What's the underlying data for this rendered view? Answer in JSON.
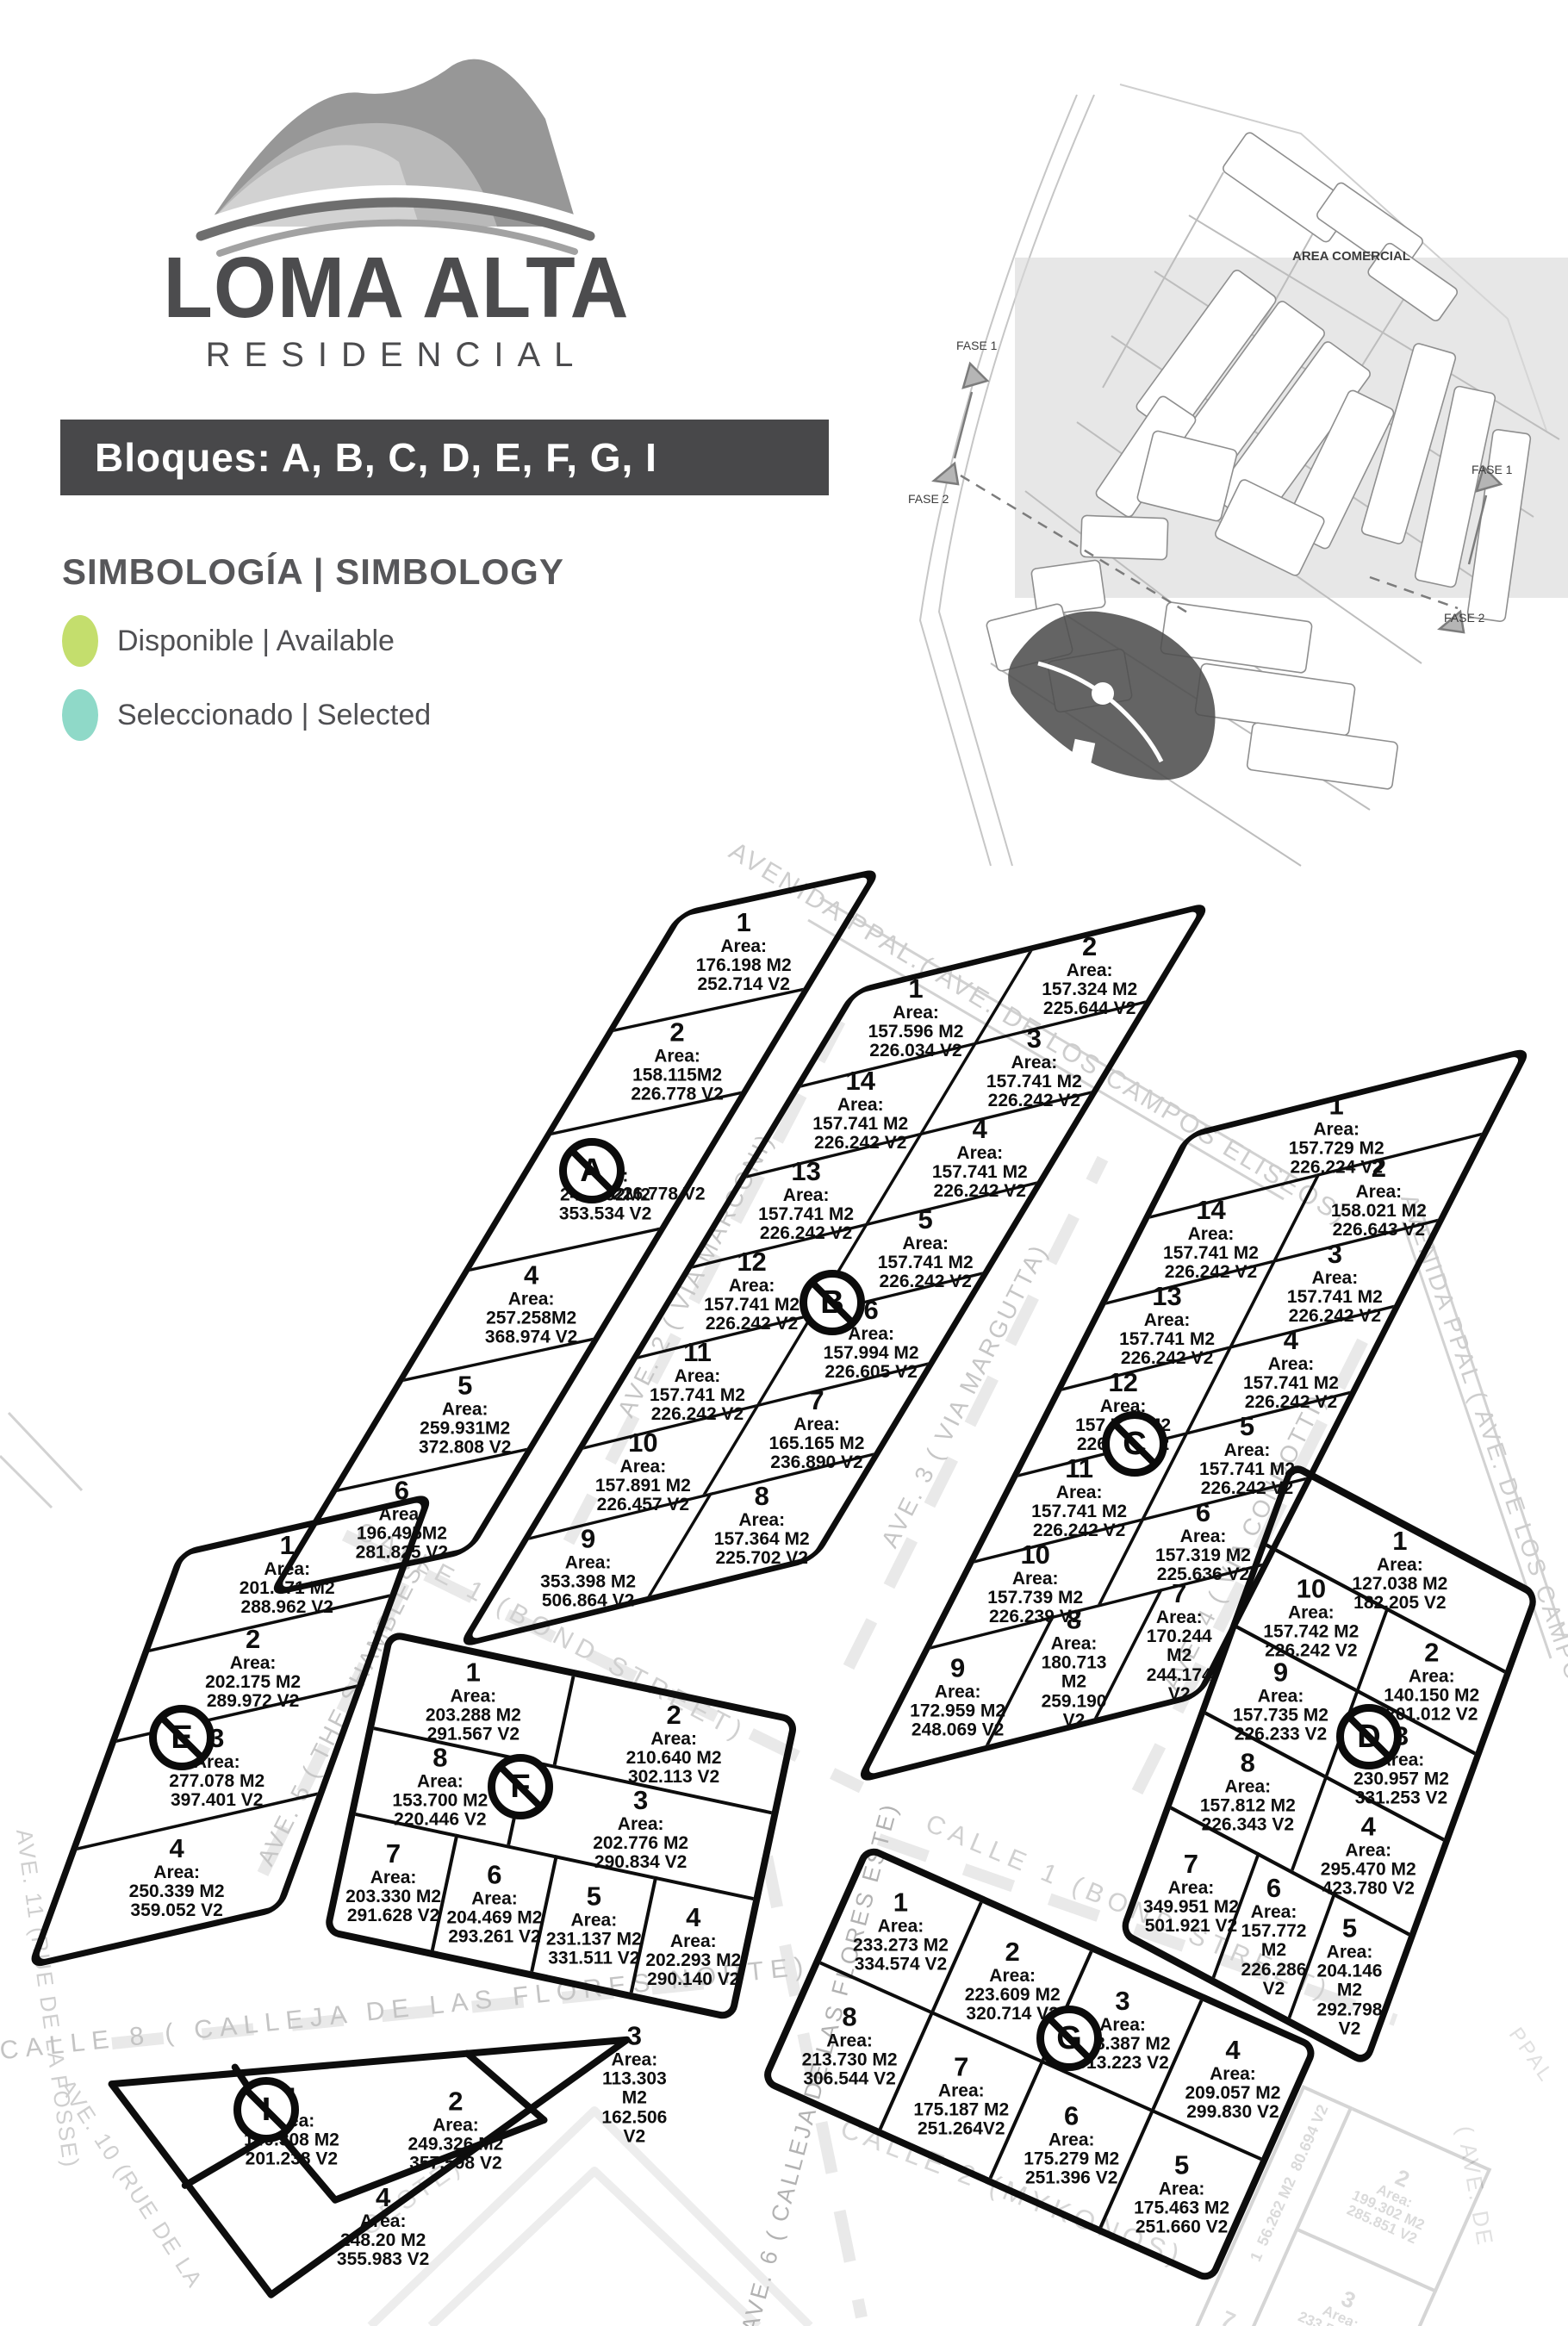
{
  "header": {
    "logo_title": "LOMA ALTA",
    "logo_subtitle": "RESIDENCIAL",
    "banner": "Bloques: A, B, C, D, E, F, G, I"
  },
  "legend": {
    "title": "SIMBOLOGÍA | SIMBOLOGY",
    "items": [
      {
        "label": "Disponible | Available",
        "color": "#c4de6d"
      },
      {
        "label": "Seleccionado | Selected",
        "color": "#8fd9c8"
      }
    ]
  },
  "overview": {
    "area_comercial": "AREA COMERCIAL",
    "fase1": "FASE 1",
    "fase2": "FASE 2"
  },
  "map": {
    "area_label": "Area:",
    "streets": [
      {
        "id": "avenida-top",
        "label": "AVENIDA PPAL.( AVE. DE LOS CAMPOS ELISEOS)"
      },
      {
        "id": "avenida-right",
        "label": "AVENIDA PPAL ( AVE. DE LOS CAMPOS"
      },
      {
        "id": "ave2",
        "label": "AVE. 2 ( VIA MARCONI)"
      },
      {
        "id": "ave3",
        "label": "AVE. 3 ( VIA MARGUTTA)"
      },
      {
        "id": "ave4",
        "label": "AVE. 4 ( VIA CONDOTTI)"
      },
      {
        "id": "ave5",
        "label": "AVE. 5 ( THE SHAMBLES)"
      },
      {
        "id": "ave6",
        "label": "AVE. 6 ( CALLEJA DE LAS FLORES ESTE)"
      },
      {
        "id": "ave10",
        "label": "AVE. 10 (RUE DE LA"
      },
      {
        "id": "ave11",
        "label": "AVE. 11 (RUE DE LA FOSSE)"
      },
      {
        "id": "calle1-upper",
        "label": "CALLE    1    (BOND STREET)"
      },
      {
        "id": "calle1-lower",
        "label": "CALLE    1    (BOND STREET)"
      },
      {
        "id": "calle8",
        "label": "CALLE 8   ( CALLEJA   DE   LAS   FLORES   NORTE)"
      },
      {
        "id": "calle2",
        "label": "CALLE   2   (MYKONOS)"
      },
      {
        "id": "oeste",
        "label": "OESTE)"
      },
      {
        "id": "faded-ave-de",
        "label": "( AVE.  DE"
      },
      {
        "id": "faded-ppal",
        "label": "PPAL"
      }
    ],
    "blocks": [
      {
        "id": "A",
        "lots": [
          {
            "n": "1",
            "m2": "176.198 M2",
            "v2": "252.714 V2"
          },
          {
            "n": "2",
            "m2": "158.115M2",
            "v2": "226.778 V2"
          },
          {
            "n": "3",
            "m2": "246.492M2",
            "v2": "353.534 V2",
            "extra": "226.778 V2"
          },
          {
            "n": "4",
            "m2": "257.258M2",
            "v2": "368.974 V2"
          },
          {
            "n": "5",
            "m2": "259.931M2",
            "v2": "372.808 V2"
          },
          {
            "n": "6",
            "m2": "196.495M2",
            "v2": "281.825 V2"
          }
        ]
      },
      {
        "id": "B",
        "lots": [
          {
            "n": "1",
            "m2": "157.596 M2",
            "v2": "226.034 V2"
          },
          {
            "n": "2",
            "m2": "157.324 M2",
            "v2": "225.644 V2"
          },
          {
            "n": "3",
            "m2": "157.741 M2",
            "v2": "226.242 V2"
          },
          {
            "n": "4",
            "m2": "157.741 M2",
            "v2": "226.242 V2"
          },
          {
            "n": "5",
            "m2": "157.741 M2",
            "v2": "226.242 V2"
          },
          {
            "n": "6",
            "m2": "157.994 M2",
            "v2": "226.605 V2"
          },
          {
            "n": "7",
            "m2": "165.165 M2",
            "v2": "236.890 V2"
          },
          {
            "n": "8",
            "m2": "157.364 M2",
            "v2": "225.702 V2"
          },
          {
            "n": "9",
            "m2": "353.398 M2",
            "v2": "506.864 V2"
          },
          {
            "n": "10",
            "m2": "157.891 M2",
            "v2": "226.457 V2"
          },
          {
            "n": "11",
            "m2": "157.741 M2",
            "v2": "226.242 V2"
          },
          {
            "n": "12",
            "m2": "157.741 M2",
            "v2": "226.242 V2"
          },
          {
            "n": "13",
            "m2": "157.741 M2",
            "v2": "226.242 V2"
          },
          {
            "n": "14",
            "m2": "157.741 M2",
            "v2": "226.242 V2"
          }
        ]
      },
      {
        "id": "C",
        "lots": [
          {
            "n": "1",
            "m2": "157.729 M2",
            "v2": "226.224 V2"
          },
          {
            "n": "2",
            "m2": "158.021 M2",
            "v2": "226.643 V2"
          },
          {
            "n": "3",
            "m2": "157.741 M2",
            "v2": "226.242 V2"
          },
          {
            "n": "4",
            "m2": "157.741 M2",
            "v2": "226.242 V2"
          },
          {
            "n": "5",
            "m2": "157.741 M2",
            "v2": "226.242 V2"
          },
          {
            "n": "6",
            "m2": "157.319 M2",
            "v2": "225.636 V2"
          },
          {
            "n": "7",
            "m2": "170.244 M2",
            "v2": "244.174 V2"
          },
          {
            "n": "8",
            "m2": "180.713 M2",
            "v2": "259.190 V2"
          },
          {
            "n": "9",
            "m2": "172.959 M2",
            "v2": "248.069 V2"
          },
          {
            "n": "10",
            "m2": "157.739 M2",
            "v2": "226.239 V2"
          },
          {
            "n": "11",
            "m2": "157.741 M2",
            "v2": "226.242 V2"
          },
          {
            "n": "12",
            "m2": "157.741 M2",
            "v2": "226.242 V2"
          },
          {
            "n": "13",
            "m2": "157.741 M2",
            "v2": "226.242 V2"
          },
          {
            "n": "14",
            "m2": "157.741 M2",
            "v2": "226.242 V2"
          }
        ]
      },
      {
        "id": "D",
        "lots": [
          {
            "n": "1",
            "m2": "127.038 M2",
            "v2": "182.205 V2"
          },
          {
            "n": "2",
            "m2": "140.150 M2",
            "v2": "201.012 V2"
          },
          {
            "n": "3",
            "m2": "230.957 M2",
            "v2": "331.253 V2"
          },
          {
            "n": "4",
            "m2": "295.470 M2",
            "v2": "423.780 V2"
          },
          {
            "n": "5",
            "m2": "204.146 M2",
            "v2": "292.798 V2"
          },
          {
            "n": "6",
            "m2": "157.772 M2",
            "v2": "226.286 V2"
          },
          {
            "n": "7",
            "m2": "349.951 M2",
            "v2": "501.921 V2"
          },
          {
            "n": "8",
            "m2": "157.812 M2",
            "v2": "226.343 V2"
          },
          {
            "n": "9",
            "m2": "157.735 M2",
            "v2": "226.233 V2"
          },
          {
            "n": "10",
            "m2": "157.742 M2",
            "v2": "226.242 V2"
          }
        ]
      },
      {
        "id": "E",
        "lots": [
          {
            "n": "1",
            "m2": "201.471 M2",
            "v2": "288.962 V2"
          },
          {
            "n": "2",
            "m2": "202.175 M2",
            "v2": "289.972 V2"
          },
          {
            "n": "3",
            "m2": "277.078 M2",
            "v2": "397.401 V2"
          },
          {
            "n": "4",
            "m2": "250.339 M2",
            "v2": "359.052 V2"
          }
        ]
      },
      {
        "id": "F",
        "lots": [
          {
            "n": "1",
            "m2": "203.288 M2",
            "v2": "291.567 V2"
          },
          {
            "n": "2",
            "m2": "210.640 M2",
            "v2": "302.113 V2"
          },
          {
            "n": "3",
            "m2": "202.776 M2",
            "v2": "290.834 V2"
          },
          {
            "n": "4",
            "m2": "202.293 M2",
            "v2": "290.140 V2"
          },
          {
            "n": "5",
            "m2": "231.137 M2",
            "v2": "331.511 V2"
          },
          {
            "n": "6",
            "m2": "204.469 M2",
            "v2": "293.261 V2"
          },
          {
            "n": "7",
            "m2": "203.330 M2",
            "v2": "291.628 V2"
          },
          {
            "n": "8",
            "m2": "153.700 M2",
            "v2": "220.446 V2"
          }
        ]
      },
      {
        "id": "G",
        "lots": [
          {
            "n": "1",
            "m2": "233.273 M2",
            "v2": "334.574 V2"
          },
          {
            "n": "2",
            "m2": "223.609 M2",
            "v2": "320.714 V2"
          },
          {
            "n": "3",
            "m2": "218.387 M2",
            "v2": "313.223 V2"
          },
          {
            "n": "4",
            "m2": "209.057 M2",
            "v2": "299.830 V2"
          },
          {
            "n": "5",
            "m2": "175.463 M2",
            "v2": "251.660 V2"
          },
          {
            "n": "6",
            "m2": "175.279 M2",
            "v2": "251.396 V2"
          },
          {
            "n": "7",
            "m2": "175.187 M2",
            "v2": "251.264V2"
          },
          {
            "n": "8",
            "m2": "213.730 M2",
            "v2": "306.544 V2"
          }
        ]
      },
      {
        "id": "I",
        "lots": [
          {
            "n": "1",
            "m2": "140.308 M2",
            "v2": "201.238 V2"
          },
          {
            "n": "2",
            "m2": "249.326 M2",
            "v2": "357.598 V2"
          },
          {
            "n": "3",
            "m2": "113.303 M2",
            "v2": "162.506 V2"
          },
          {
            "n": "4",
            "m2": "248.20 M2",
            "v2": "355.983 V2"
          }
        ]
      }
    ],
    "faded_lots": [
      {
        "n": "1",
        "m2": "56.262 M2",
        "v2": "80.694 V2"
      },
      {
        "n": "2",
        "m2": "199.302 M2",
        "v2": "285.851 V2"
      },
      {
        "n": "3",
        "m2": "233.551 M2",
        "v2": "334.973 V2"
      },
      {
        "n": "7",
        "m2": "",
        "v2": ""
      }
    ]
  }
}
